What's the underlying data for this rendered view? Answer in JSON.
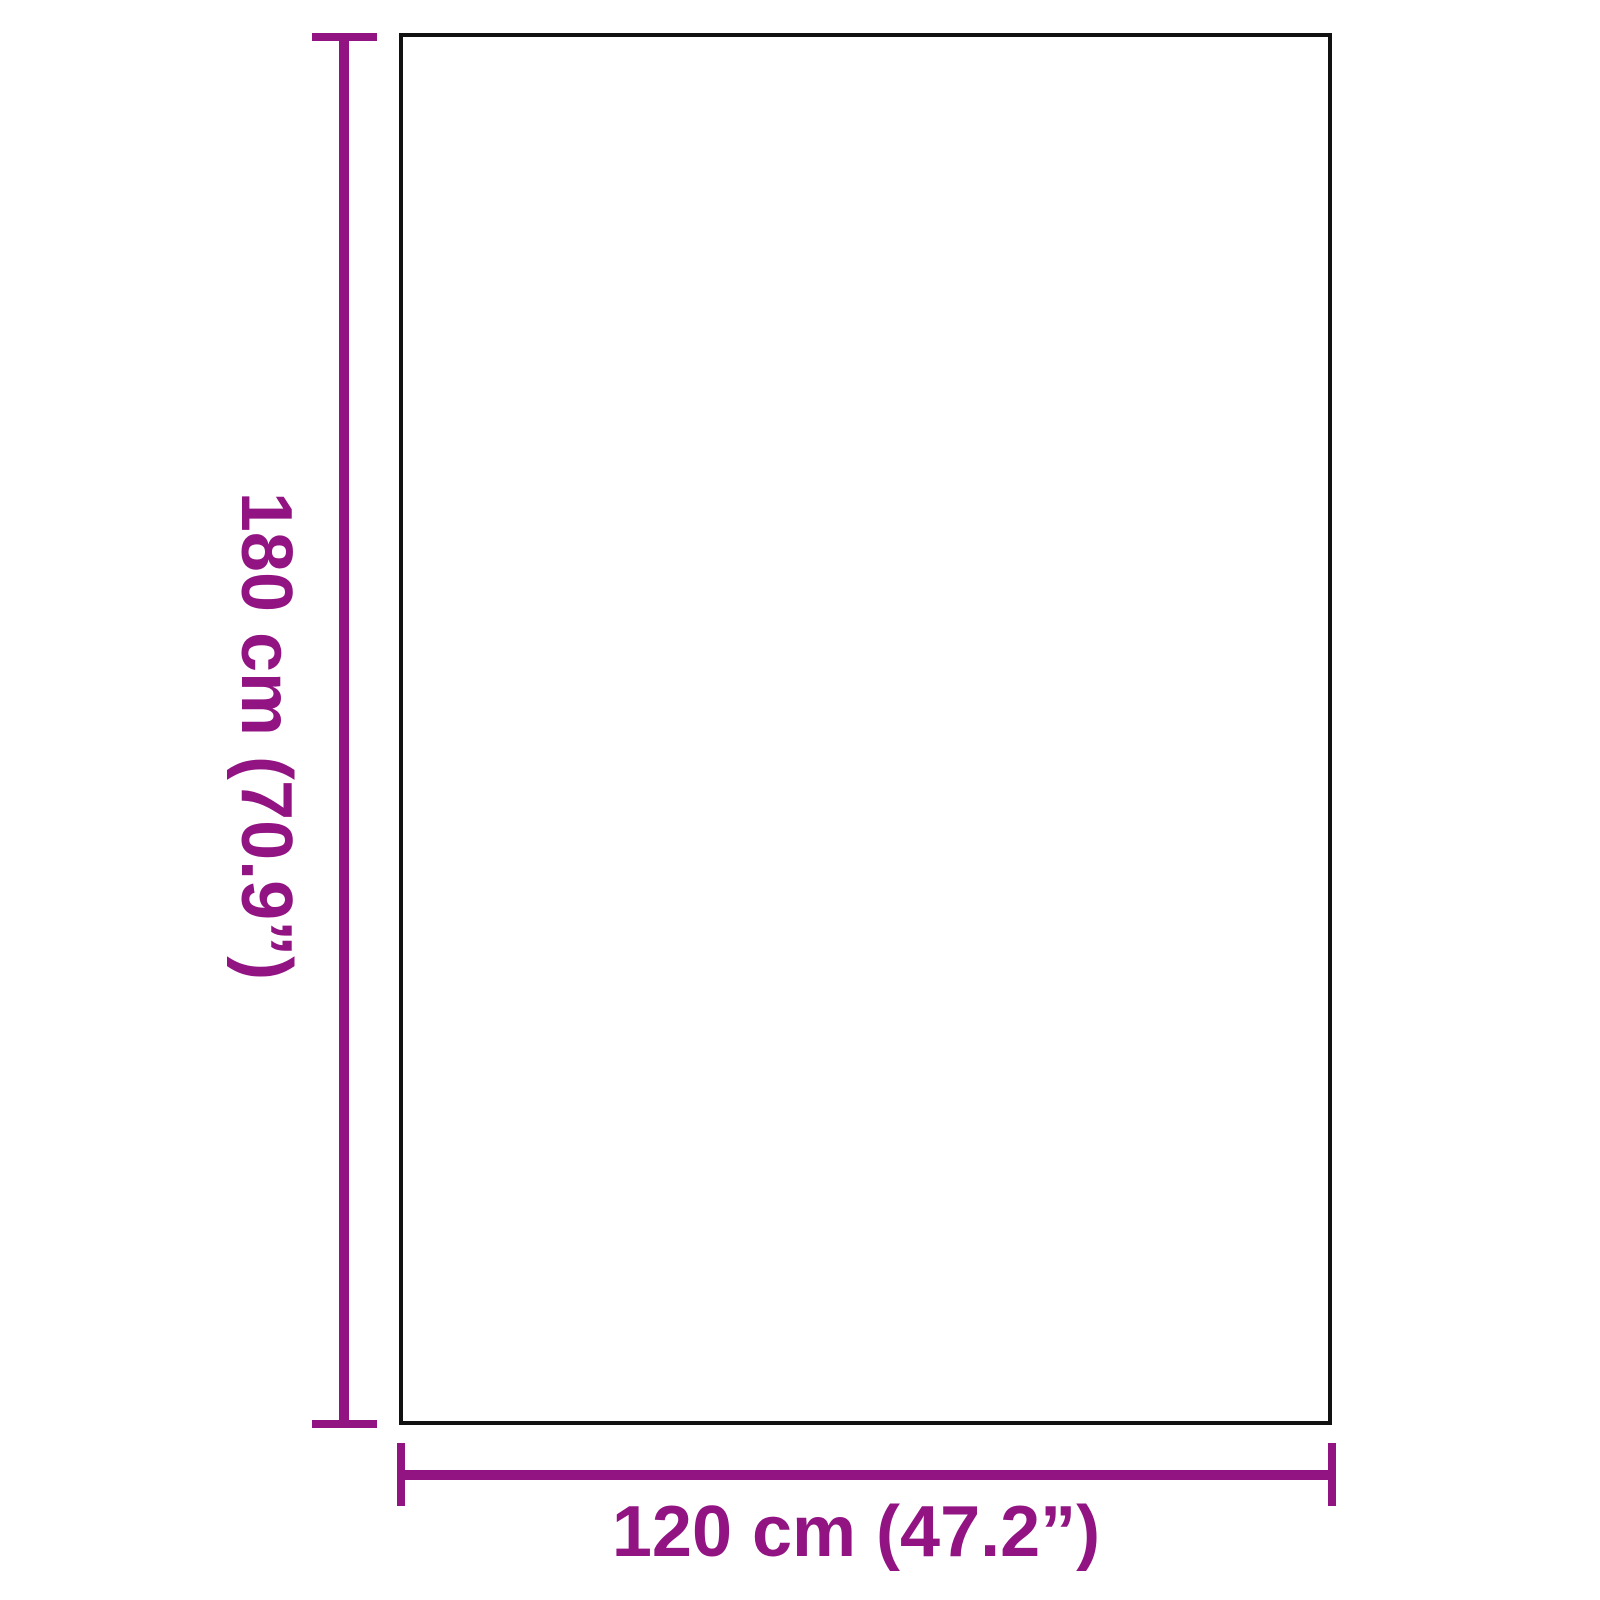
{
  "diagram": {
    "type": "product-dimension-diagram",
    "vertical_dimension": {
      "label": "180 cm (70.9”)",
      "value_cm": 180,
      "value_inches": 70.9
    },
    "horizontal_dimension": {
      "label": "120 cm (47.2”)",
      "value_cm": 120,
      "value_inches": 47.2
    },
    "colors": {
      "accent": "#911482",
      "outline": "#111111",
      "background": "#ffffff"
    }
  }
}
